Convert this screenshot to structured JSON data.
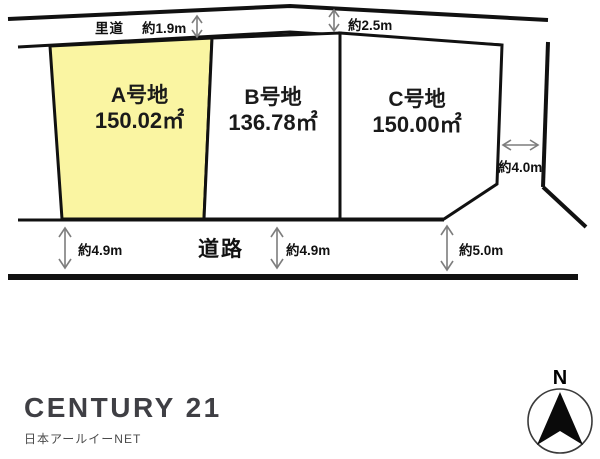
{
  "plots": [
    {
      "name": "A号地",
      "area": "150.02㎡"
    },
    {
      "name": "B号地",
      "area": "136.78㎡"
    },
    {
      "name": "C号地",
      "area": "150.00㎡"
    }
  ],
  "labels": {
    "satomichi": "里道",
    "road": "道路",
    "dim_top_left": "約1.9m",
    "dim_top_right": "約2.5m",
    "dim_right": "約4.0m",
    "dim_bottom_left": "約4.9m",
    "dim_bottom_mid": "約4.9m",
    "dim_bottom_right": "約5.0m"
  },
  "compass": {
    "north": "N"
  },
  "branding": {
    "logo": "CENTURY 21",
    "company": "日本アールイーNET"
  },
  "colors": {
    "plot_a_fill": "#faf5a2",
    "line": "#111111",
    "arrow": "#7d7d7d",
    "logo_text": "#3f3f44"
  }
}
